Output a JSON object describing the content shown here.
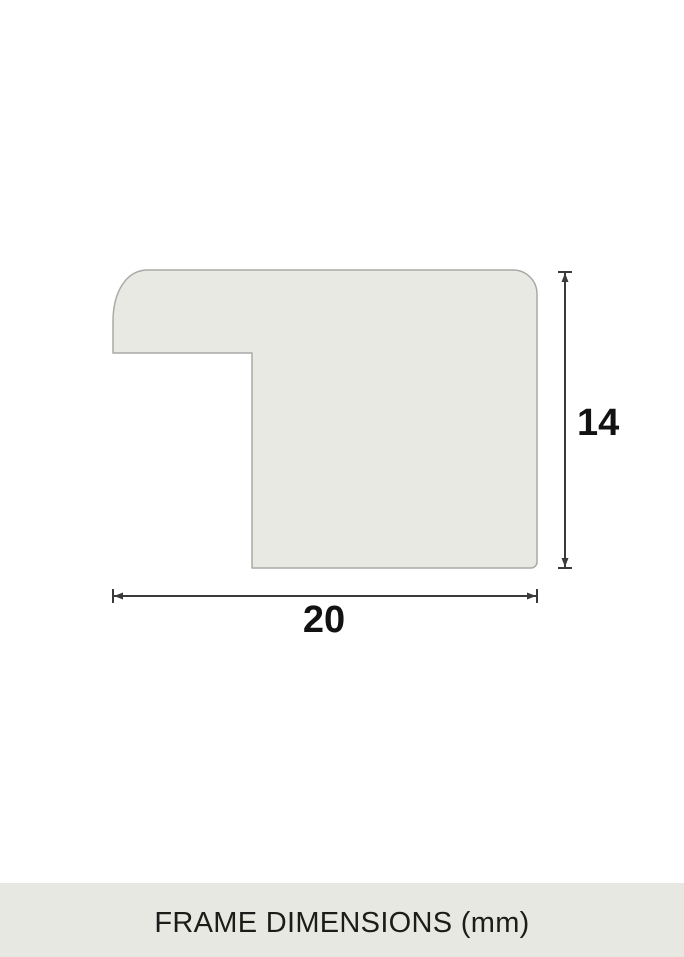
{
  "diagram": {
    "height_label": "14",
    "width_label": "20",
    "profile": {
      "width_mm": 20,
      "height_mm": 14,
      "unit": "mm"
    },
    "colors": {
      "shape_fill": "#e9e9e4",
      "shape_stroke": "#a9a9a6",
      "dimension_line": "#3a3a3a",
      "label_text": "#121212"
    }
  },
  "footer": {
    "label": "FRAME DIMENSIONS (mm)",
    "background": "#e8e8e2",
    "text_color": "#1c1c1a"
  }
}
